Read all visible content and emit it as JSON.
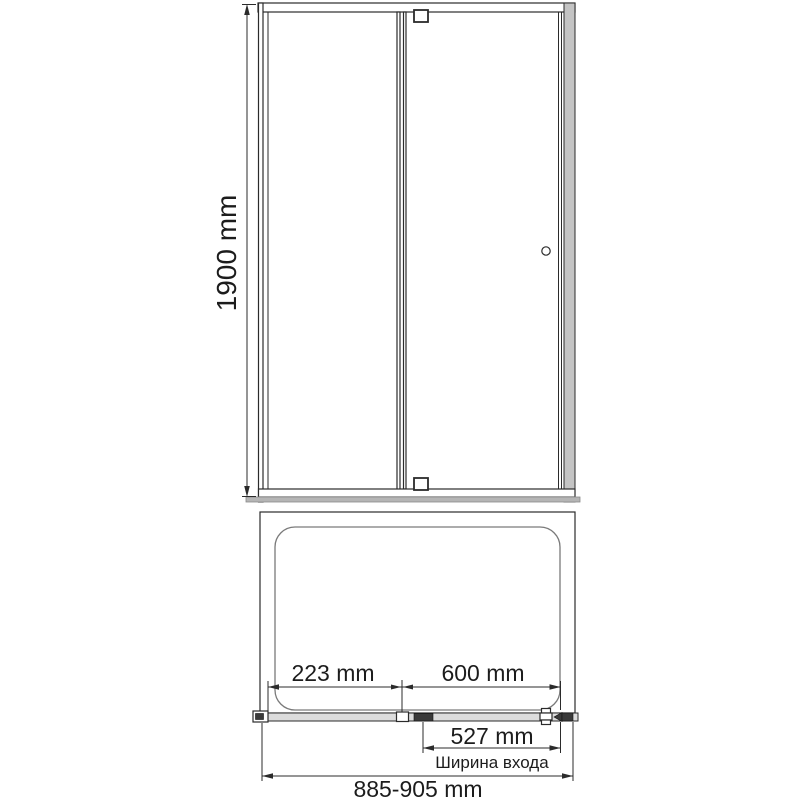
{
  "front_view": {
    "height_label": "1900 mm"
  },
  "top_view": {
    "fixed_panel_width_label": "223 mm",
    "door_width_label": "600 mm",
    "entry_width_label": "527 mm",
    "entry_width_caption": "Ширина входа",
    "overall_width_label": "885-905 mm"
  },
  "colors": {
    "line": "#2b2b2b",
    "profile_gray": "#c4c4c4",
    "threshold_gray": "#b5b5b5",
    "track_gray": "#dcdcdc",
    "dark_hardware": "#3a3a3a",
    "background": "#ffffff"
  }
}
